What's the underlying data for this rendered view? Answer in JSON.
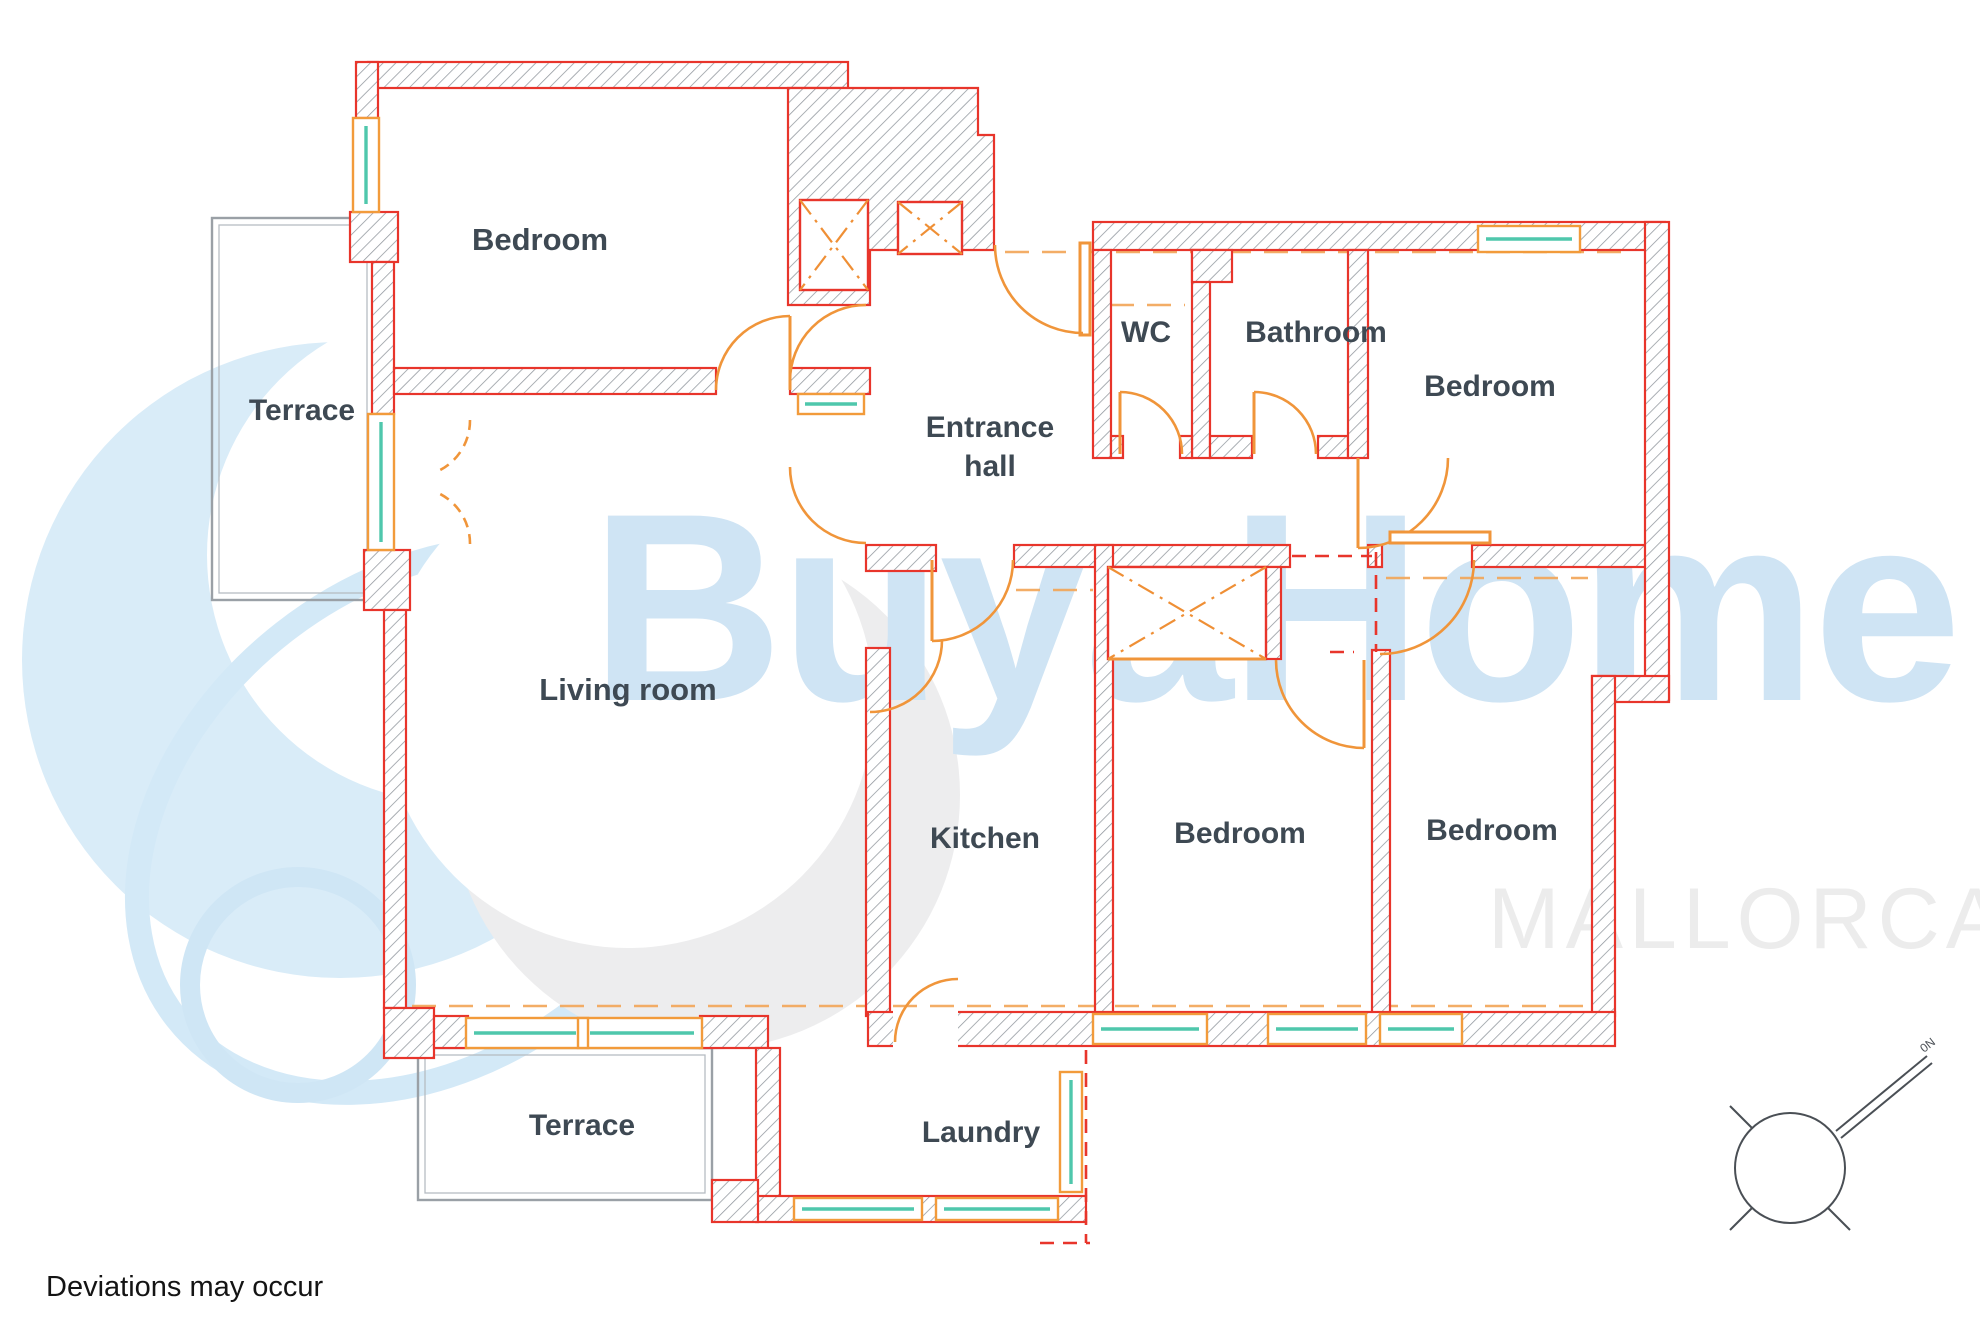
{
  "title": "Apartment floor plan",
  "rooms": {
    "bedroom_tl": "Bedroom",
    "terrace_left": "Terrace",
    "living_room": "Living room",
    "entrance_line1": "Entrance",
    "entrance_line2": "hall",
    "wc": "WC",
    "bathroom": "Bathroom",
    "bedroom_tr": "Bedroom",
    "kitchen": "Kitchen",
    "bedroom_m": "Bedroom",
    "bedroom_br": "Bedroom",
    "laundry": "Laundry",
    "terrace_bottom": "Terrace"
  },
  "watermark": {
    "brand": "BuyaHome",
    "region": "MALLORCA",
    "brand_color": "#cfe4f4",
    "region_color": "#ececec",
    "logo_blue": "#d9ecf8",
    "logo_gray": "#ededee"
  },
  "footer": {
    "disclaimer": "Deviations may occur"
  },
  "compass": {
    "label": "0N"
  },
  "colors": {
    "wall_red": "#e8352b",
    "hatch_gray": "#8f959c",
    "door_orange": "#f0953a",
    "glass_teal": "#4fc7ac",
    "terrace_gray": "#9aa0a6",
    "label_dark": "#3e4953"
  }
}
